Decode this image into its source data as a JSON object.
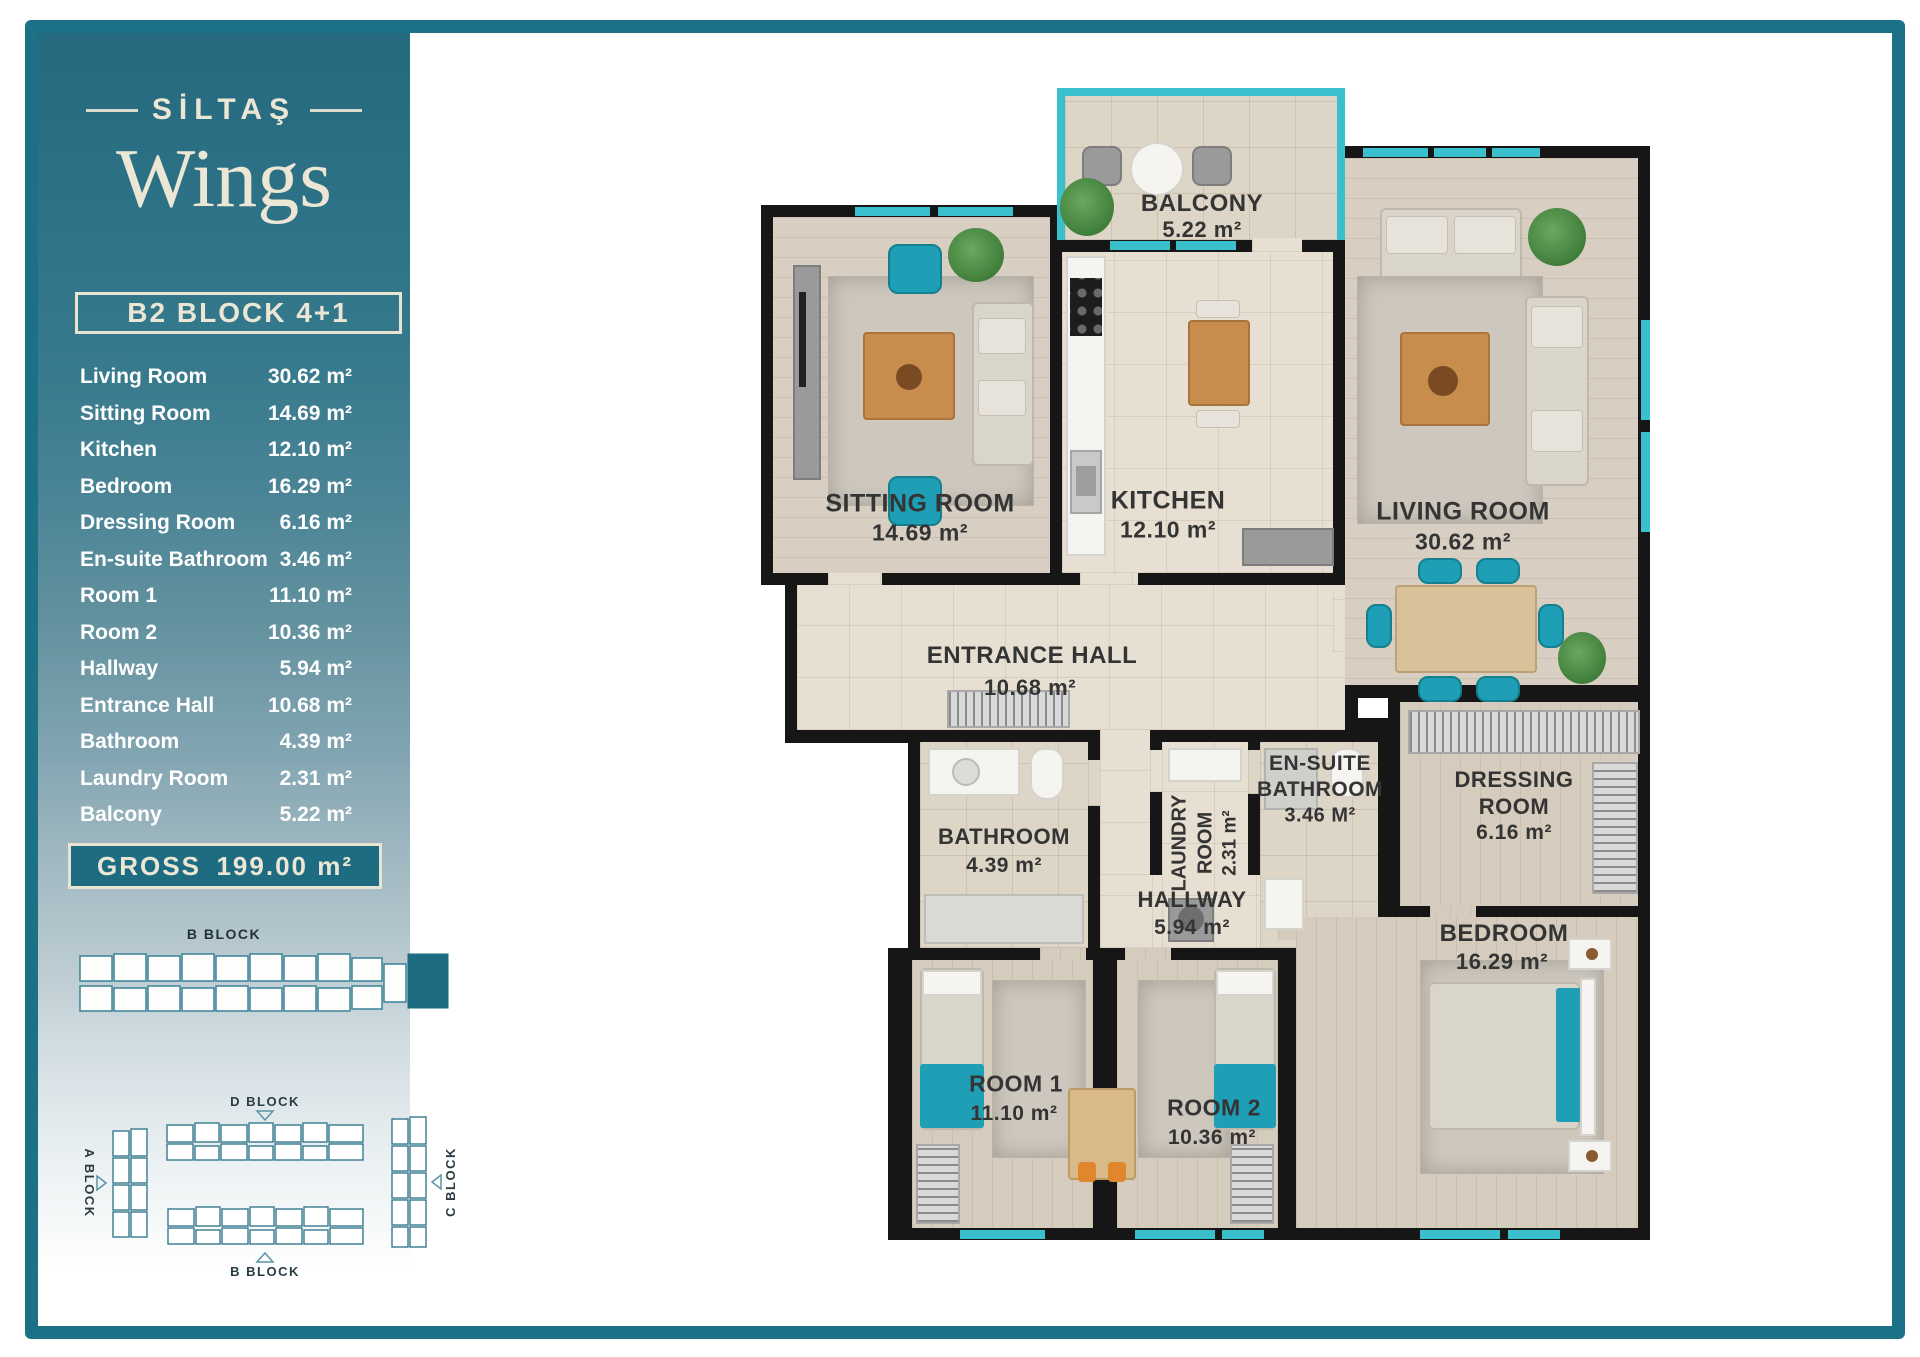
{
  "brand": {
    "name": "SİLTAŞ",
    "product": "Wings"
  },
  "header": {
    "block_title": "B2 BLOCK 4+1"
  },
  "area_list": [
    {
      "label": "Living Room",
      "value": "30.62 m²"
    },
    {
      "label": "Sitting Room",
      "value": "14.69 m²"
    },
    {
      "label": "Kitchen",
      "value": "12.10 m²"
    },
    {
      "label": "Bedroom",
      "value": "16.29 m²"
    },
    {
      "label": "Dressing Room",
      "value": "6.16 m²"
    },
    {
      "label": "En-suite Bathroom",
      "value": "3.46 m²"
    },
    {
      "label": "Room 1",
      "value": "11.10 m²"
    },
    {
      "label": "Room 2",
      "value": "10.36 m²"
    },
    {
      "label": "Hallway",
      "value": "5.94 m²"
    },
    {
      "label": "Entrance Hall",
      "value": "10.68 m²"
    },
    {
      "label": "Bathroom",
      "value": "4.39 m²"
    },
    {
      "label": "Laundry Room",
      "value": "2.31 m²"
    },
    {
      "label": "Balcony",
      "value": "5.22 m²"
    }
  ],
  "gross": {
    "label": "GROSS",
    "value": "199.00 m²"
  },
  "block_diagram": {
    "label": "B BLOCK"
  },
  "site_plan": {
    "d_label": "D BLOCK",
    "a_label": "A BLOCK",
    "c_label": "C BLOCK",
    "b_label": "B BLOCK"
  },
  "plan": {
    "balcony": {
      "name": "BALCONY",
      "area": "5.22 m²"
    },
    "sitting_room": {
      "name": "SITTING ROOM",
      "area": "14.69 m²"
    },
    "kitchen": {
      "name": "KITCHEN",
      "area": "12.10 m²"
    },
    "living_room": {
      "name": "LIVING ROOM",
      "area": "30.62 m²"
    },
    "entrance_hall": {
      "name": "ENTRANCE HALL",
      "area": "10.68 m²"
    },
    "bathroom": {
      "name": "BATHROOM",
      "area": "4.39 m²"
    },
    "laundry_room": {
      "line1": "LAUNDRY",
      "line2": "ROOM",
      "area": "2.31 m²"
    },
    "ensuite_bathroom": {
      "line1": "EN-SUITE",
      "line2": "BATHROOM",
      "area": "3.46 M²"
    },
    "dressing_room": {
      "line1": "DRESSING",
      "line2": "ROOM",
      "area": "6.16 m²"
    },
    "hallway": {
      "name": "HALLWAY",
      "area": "5.94 m²"
    },
    "room1": {
      "name": "ROOM 1",
      "area": "11.10 m²"
    },
    "room2": {
      "name": "ROOM 2",
      "area": "10.36 m²"
    },
    "bedroom": {
      "name": "BEDROOM",
      "area": "16.29 m²"
    }
  },
  "colors": {
    "accent_teal": "#1d7186",
    "window_aqua": "#3ac0cd",
    "cream": "#ece6d5",
    "wall": "#161616"
  }
}
